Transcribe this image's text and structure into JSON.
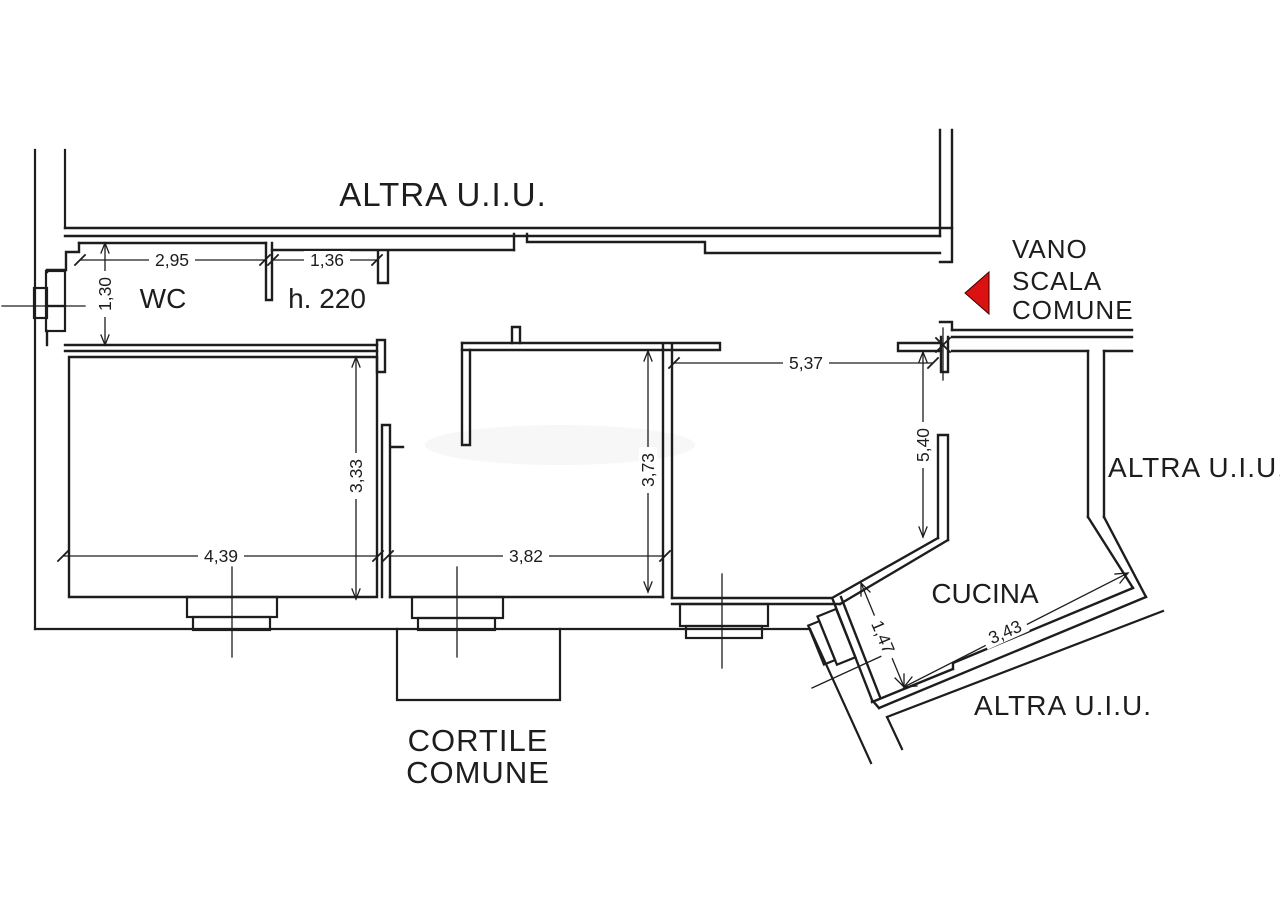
{
  "plan": {
    "type": "cadastral-floor-plan",
    "context_labels": {
      "altra_uiu_top": "ALTRA U.I.U.",
      "altra_uiu_right": "ALTRA U.I.U.",
      "altra_uiu_bottom": "ALTRA U.I.U.",
      "vano_scala_line1": "VANO",
      "vano_scala_line2": "SCALA",
      "vano_scala_line3": "COMUNE",
      "cortile_line1": "CORTILE",
      "cortile_line2": "COMUNE"
    },
    "room_labels": {
      "wc": "WC",
      "height_note": "h. 220",
      "cucina": "CUCINA"
    },
    "dimensions": {
      "wc_width": "2,95",
      "hall_width": "1,36",
      "wc_depth": "1,30",
      "room_left_width": "4,39",
      "room_left_depth": "3,33",
      "room_mid_width": "3,82",
      "room_mid_depth": "3,73",
      "room_right_width": "5,37",
      "room_right_depth": "5,40",
      "kitchen_door": "1,47",
      "kitchen_width": "3,43"
    },
    "colors": {
      "line": "#1d1d1d",
      "entrance_arrow": "#dc1212",
      "background": "#ffffff"
    }
  }
}
